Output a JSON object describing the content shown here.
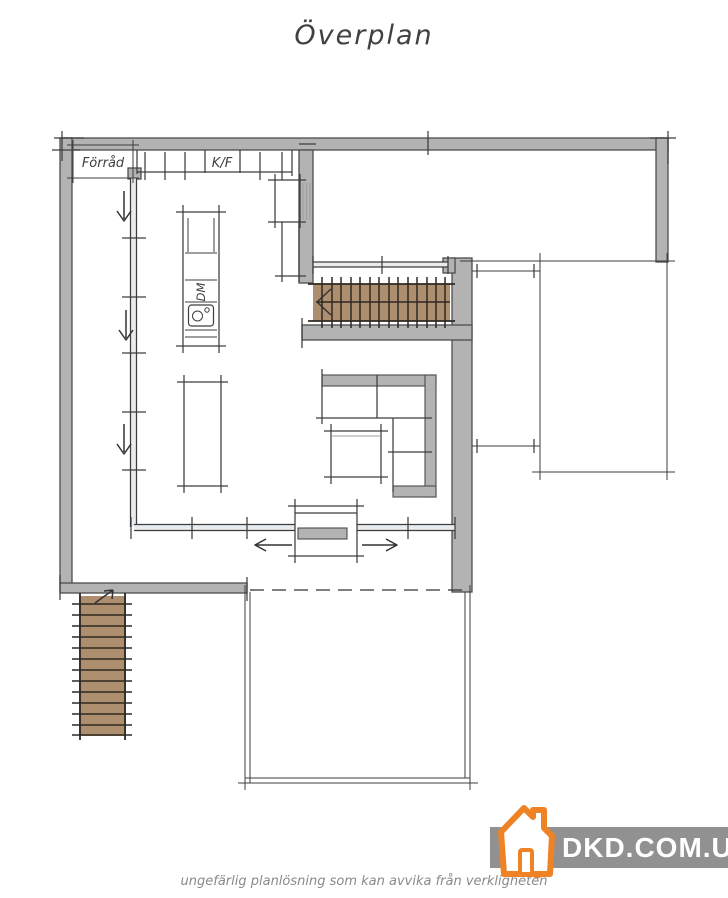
{
  "header": {
    "title": "Överplan",
    "color": "#414141"
  },
  "plan": {
    "labels": {
      "storage": "Förråd",
      "kitchen_appliance": "K/F",
      "dishwasher": "DM"
    },
    "colors": {
      "wall_fill": "#b3b3b3",
      "wall_stroke": "#4d4d4d",
      "line": "#3d3d3d",
      "light_line": "#9aa0a4",
      "glazing_fill": "#e9ecee",
      "stair_fill": "#ad8e6e",
      "stair_tread": "#2e2922",
      "label": "#3f3f3f"
    }
  },
  "footer": {
    "caption": "ungefärlig planlösning som kan avvika från verkligheten",
    "text_color": "#8a8a8a"
  },
  "watermark": {
    "text": "DKD.COM.UA",
    "band": "#919191",
    "accent": "#f08226",
    "text_color": "#ffffff",
    "icon": "house-icon"
  }
}
